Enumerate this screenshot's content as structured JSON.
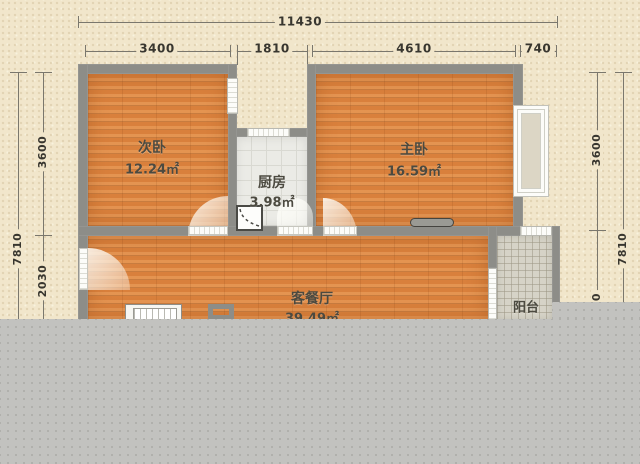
{
  "plan": {
    "type": "apartment-floorplan",
    "colors": {
      "background": "#f1e6cb",
      "wall": "#8d8d88",
      "wood_floor": "#dd8440",
      "tile_floor": "#ebebe6",
      "balcony_floor": "#d6d3c7",
      "overlay_grey": "#c2c2bf",
      "dimension_text": "#38362f",
      "room_text": "#4c4a40"
    }
  },
  "dimensions": {
    "top": {
      "total": "11430",
      "segments": [
        "3400",
        "1810",
        "4610",
        "740"
      ]
    },
    "left": {
      "outer_total": "7810",
      "inner_segments": [
        "3600",
        "2030"
      ]
    },
    "right": {
      "inner_segments": [
        "3600",
        "0"
      ],
      "outer_total": "7810"
    }
  },
  "rooms": {
    "bedroom2": {
      "name": "次卧",
      "area": "12.24㎡"
    },
    "kitchen": {
      "name": "厨房",
      "area": "3.98㎡"
    },
    "master": {
      "name": "主卧",
      "area": "16.59㎡"
    },
    "living": {
      "name": "客餐厅",
      "area": "39.49㎡"
    },
    "balcony": {
      "name": "阳台"
    }
  }
}
